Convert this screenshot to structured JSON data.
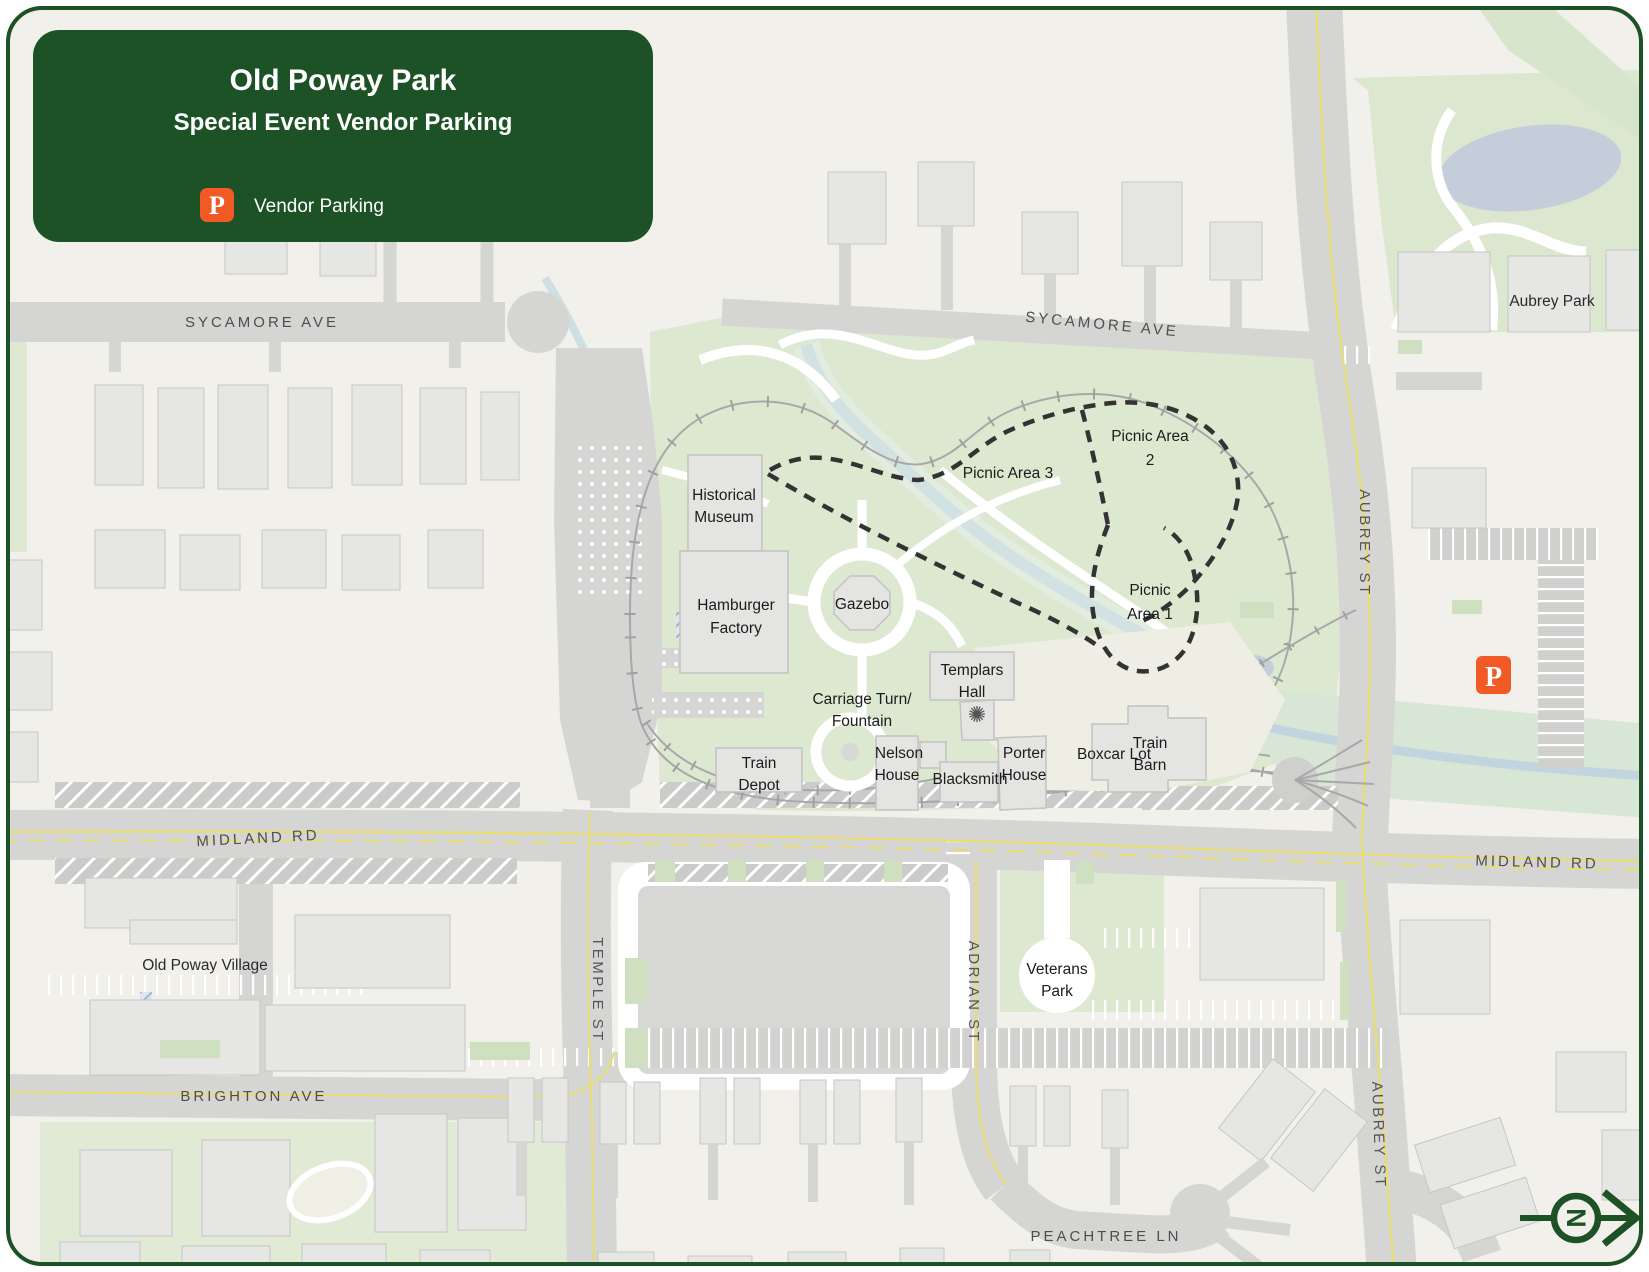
{
  "colors": {
    "pine": "#1d5227",
    "orange": "#f15a24",
    "bg": "#f1f0ea",
    "park_green": "#dce8d0",
    "road": "#d5d5d4",
    "building": "#e6e6e4",
    "water": "#c4cedb"
  },
  "header": {
    "title": "Old Poway Park",
    "subtitle": "Special Event Vendor Parking",
    "legend_symbol": "P",
    "legend_label": "Vendor Parking"
  },
  "marker": {
    "symbol": "P"
  },
  "compass": {
    "north": "N"
  },
  "streets": {
    "sycamore_w": "SYCAMORE AVE",
    "sycamore_e": "SYCAMORE AVE",
    "aubrey_n": "AUBREY ST",
    "aubrey_s": "AUBREY ST",
    "midland_w": "MIDLAND RD",
    "midland_e": "MIDLAND RD",
    "temple": "TEMPLE ST",
    "adrian": "ADRIAN ST",
    "brighton": "BRIGHTON AVE",
    "peachtree": "PEACHTREE LN"
  },
  "places": {
    "aubrey_park": "Aubrey Park",
    "old_poway_village": "Old Poway Village",
    "veterans_1": "Veterans",
    "veterans_2": "Park",
    "historical_1": "Historical",
    "historical_2": "Museum",
    "hamburger_1": "Hamburger",
    "hamburger_2": "Factory",
    "gazebo": "Gazebo",
    "templars_1": "Templars",
    "templars_2": "Hall",
    "porter_1": "Porter",
    "porter_2": "House",
    "boxcar": "Boxcar Lot",
    "carriage_1": "Carriage Turn/",
    "carriage_2": "Fountain",
    "depot_1": "Train",
    "depot_2": "Depot",
    "nelson_1": "Nelson",
    "nelson_2": "House",
    "blacksmith": "Blacksmith",
    "barn_1": "Train",
    "barn_2": "Barn",
    "picnic3": "Picnic Area 3",
    "picnic2_1": "Picnic Area",
    "picnic2_2": "2",
    "picnic1_1": "Picnic",
    "picnic1_2": "Area 1"
  }
}
